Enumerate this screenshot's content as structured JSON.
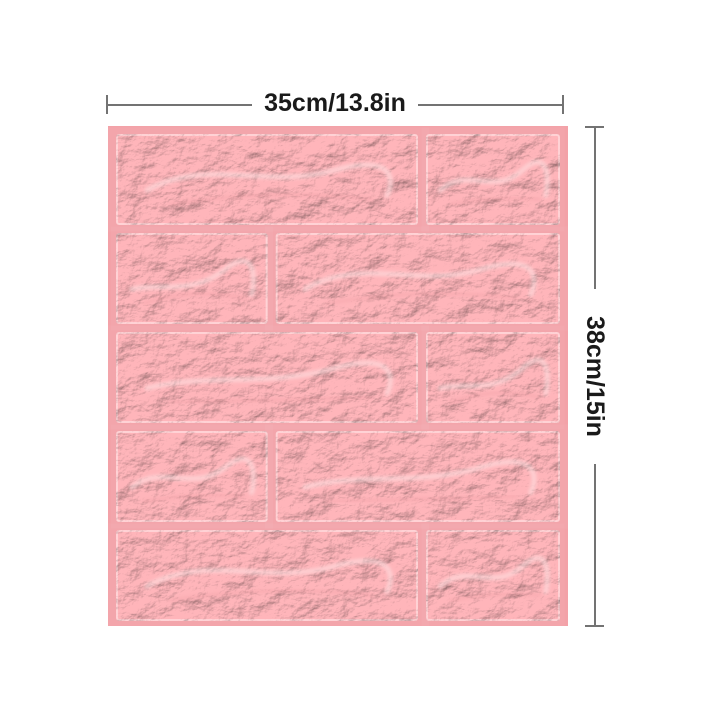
{
  "image": {
    "subject": "pink 3D embossed foam brick wall panel, front view on white background",
    "background_color": "#ffffff"
  },
  "annotations": {
    "width_label": "35cm/13.8in",
    "height_label": "38cm/15in",
    "line_color": "#737373",
    "text_color": "#1a1a1a"
  },
  "panel": {
    "mortar_color": "#f3a2a8",
    "brick_color": "#f5abb0",
    "brick_edge_color": "#f9c8cb",
    "highlight_color": "#fce3e4",
    "shadow_color": "#e9969d",
    "brick_grid": {
      "rows": 5,
      "row_splits": [
        [
          0.69
        ],
        [
          0.35
        ],
        [
          0.69
        ],
        [
          0.35
        ],
        [
          0.69
        ]
      ]
    }
  }
}
